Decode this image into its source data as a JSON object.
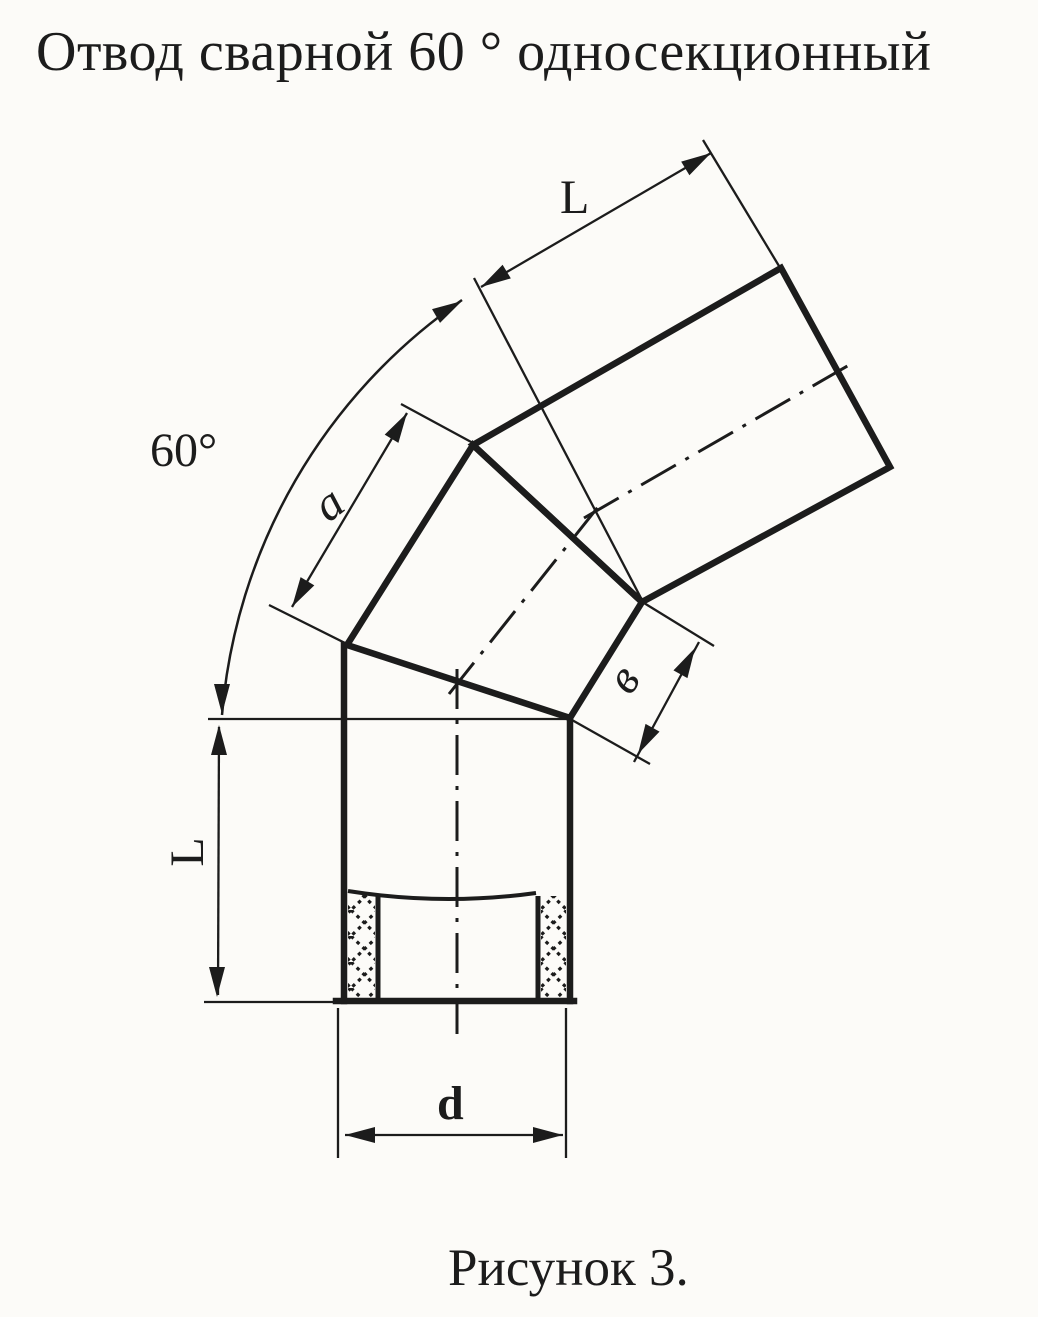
{
  "document": {
    "title": "Отвод сварной 60 ° односекционный",
    "caption": "Рисунок 3."
  },
  "drawing": {
    "description": "technical drawing of a welded 60-degree one-section pipe elbow with two weld seams, socket joint at bottom",
    "dimension_labels": {
      "angle": "60°",
      "upper_pipe_length": "L",
      "middle_section_outer_edge": "a",
      "middle_section_inner_edge": "в",
      "lower_pipe_length": "L",
      "diameter": "d"
    },
    "colors": {
      "ink": "#1c1c1c",
      "paper": "#fcfbf8"
    }
  }
}
